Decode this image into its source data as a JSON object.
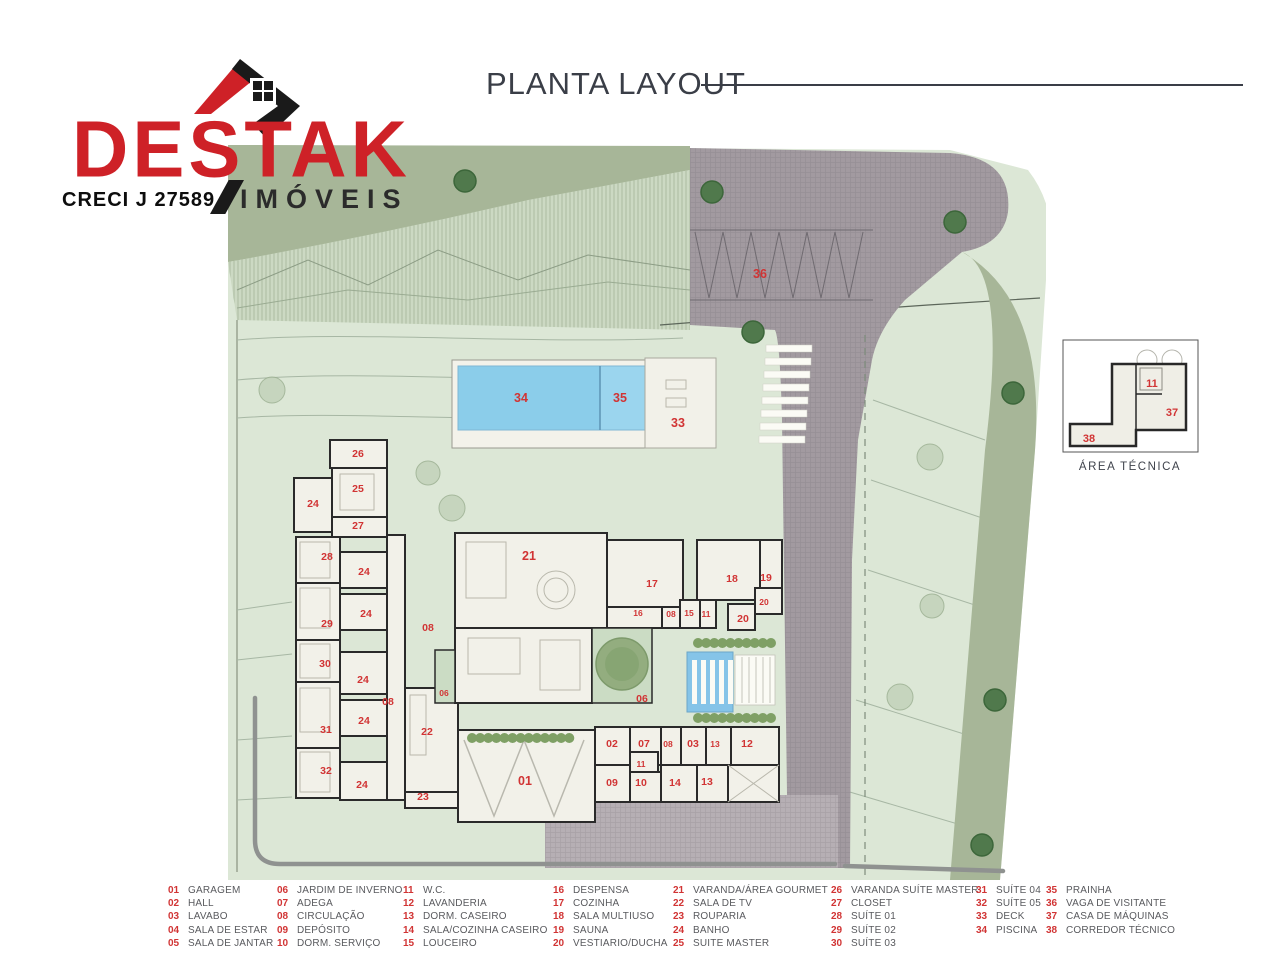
{
  "logo": {
    "brand": "DESTAK",
    "brand_sub": "IMÓVEIS",
    "creci": "CRECI J 27589",
    "brand_color": "#ce2127",
    "sub_color": "#2b2b2b"
  },
  "title": "PLANTA LAYOUT",
  "inset": {
    "caption": "ÁREA TÉCNICA",
    "labels": [
      {
        "n": "11",
        "x": 90,
        "y": 49
      },
      {
        "n": "37",
        "x": 110,
        "y": 78
      },
      {
        "n": "38",
        "x": 27,
        "y": 104
      }
    ]
  },
  "plan": {
    "colors": {
      "lot_green": "#dce7d6",
      "verge_sage": "#a7b698",
      "road_gray": "#a29aa0",
      "pool_blue": "#8bcdea",
      "room_fill": "#f2f1e9",
      "wall": "#2a2a2a",
      "number_red": "#d13434"
    },
    "labels": [
      {
        "n": "36",
        "x": 532,
        "y": 138,
        "s": "lg"
      },
      {
        "n": "34",
        "x": 293,
        "y": 262,
        "s": "lg"
      },
      {
        "n": "35",
        "x": 392,
        "y": 262,
        "s": "lg"
      },
      {
        "n": "33",
        "x": 450,
        "y": 287,
        "s": "lg"
      },
      {
        "n": "26",
        "x": 130,
        "y": 317
      },
      {
        "n": "25",
        "x": 130,
        "y": 352
      },
      {
        "n": "24",
        "x": 85,
        "y": 367
      },
      {
        "n": "27",
        "x": 130,
        "y": 389
      },
      {
        "n": "28",
        "x": 99,
        "y": 420
      },
      {
        "n": "24",
        "x": 136,
        "y": 435
      },
      {
        "n": "24",
        "x": 138,
        "y": 477
      },
      {
        "n": "29",
        "x": 99,
        "y": 487
      },
      {
        "n": "08",
        "x": 200,
        "y": 491
      },
      {
        "n": "30",
        "x": 97,
        "y": 527
      },
      {
        "n": "24",
        "x": 135,
        "y": 543
      },
      {
        "n": "06",
        "x": 216,
        "y": 556,
        "s": "sm"
      },
      {
        "n": "08",
        "x": 160,
        "y": 565
      },
      {
        "n": "24",
        "x": 136,
        "y": 584
      },
      {
        "n": "31",
        "x": 98,
        "y": 593
      },
      {
        "n": "22",
        "x": 199,
        "y": 595
      },
      {
        "n": "32",
        "x": 98,
        "y": 634
      },
      {
        "n": "24",
        "x": 134,
        "y": 648
      },
      {
        "n": "23",
        "x": 195,
        "y": 660
      },
      {
        "n": "21",
        "x": 301,
        "y": 420,
        "s": "lg"
      },
      {
        "n": "17",
        "x": 424,
        "y": 447
      },
      {
        "n": "16",
        "x": 410,
        "y": 476,
        "s": "sm"
      },
      {
        "n": "08",
        "x": 443,
        "y": 477,
        "s": "sm"
      },
      {
        "n": "15",
        "x": 461,
        "y": 476,
        "s": "sm"
      },
      {
        "n": "11",
        "x": 478,
        "y": 477,
        "s": "sm"
      },
      {
        "n": "18",
        "x": 504,
        "y": 442
      },
      {
        "n": "19",
        "x": 538,
        "y": 441
      },
      {
        "n": "20",
        "x": 536,
        "y": 465,
        "s": "sm"
      },
      {
        "n": "20",
        "x": 515,
        "y": 482
      },
      {
        "n": "06",
        "x": 414,
        "y": 562
      },
      {
        "n": "01",
        "x": 297,
        "y": 645,
        "s": "lg"
      },
      {
        "n": "02",
        "x": 384,
        "y": 607
      },
      {
        "n": "07",
        "x": 416,
        "y": 607
      },
      {
        "n": "08",
        "x": 440,
        "y": 607,
        "s": "sm"
      },
      {
        "n": "03",
        "x": 465,
        "y": 607
      },
      {
        "n": "13",
        "x": 487,
        "y": 607,
        "s": "sm"
      },
      {
        "n": "12",
        "x": 519,
        "y": 607
      },
      {
        "n": "09",
        "x": 384,
        "y": 646
      },
      {
        "n": "11",
        "x": 413,
        "y": 627,
        "s": "sm"
      },
      {
        "n": "10",
        "x": 413,
        "y": 646
      },
      {
        "n": "14",
        "x": 447,
        "y": 646
      },
      {
        "n": "13",
        "x": 479,
        "y": 645
      }
    ]
  },
  "legend": {
    "groups": [
      [
        {
          "n": "01",
          "label": "GARAGEM"
        },
        {
          "n": "02",
          "label": "HALL"
        },
        {
          "n": "03",
          "label": "LAVABO"
        },
        {
          "n": "04",
          "label": "SALA DE ESTAR"
        },
        {
          "n": "05",
          "label": "SALA DE JANTAR"
        }
      ],
      [
        {
          "n": "06",
          "label": "JARDIM DE INVERNO"
        },
        {
          "n": "07",
          "label": "ADEGA"
        },
        {
          "n": "08",
          "label": "CIRCULAÇÃO"
        },
        {
          "n": "09",
          "label": "DEPÓSITO"
        },
        {
          "n": "10",
          "label": "DORM. SERVIÇO"
        }
      ],
      [
        {
          "n": "11",
          "label": "W.C."
        },
        {
          "n": "12",
          "label": "LAVANDERIA"
        },
        {
          "n": "13",
          "label": "DORM. CASEIRO"
        },
        {
          "n": "14",
          "label": "SALA/COZINHA CASEIRO"
        },
        {
          "n": "15",
          "label": "LOUCEIRO"
        }
      ],
      [
        {
          "n": "16",
          "label": "DESPENSA"
        },
        {
          "n": "17",
          "label": "COZINHA"
        },
        {
          "n": "18",
          "label": "SALA MULTIUSO"
        },
        {
          "n": "19",
          "label": "SAUNA"
        },
        {
          "n": "20",
          "label": "VESTIARIO/DUCHA"
        }
      ],
      [
        {
          "n": "21",
          "label": "VARANDA/ÁREA GOURMET"
        },
        {
          "n": "22",
          "label": "SALA DE TV"
        },
        {
          "n": "23",
          "label": "ROUPARIA"
        },
        {
          "n": "24",
          "label": "BANHO"
        },
        {
          "n": "25",
          "label": "SUITE MASTER"
        }
      ],
      [
        {
          "n": "26",
          "label": "VARANDA SUÍTE MASTER"
        },
        {
          "n": "27",
          "label": "CLOSET"
        },
        {
          "n": "28",
          "label": "SUÍTE 01"
        },
        {
          "n": "29",
          "label": "SUÍTE 02"
        },
        {
          "n": "30",
          "label": "SUÍTE 03"
        }
      ],
      [
        {
          "n": "31",
          "label": "SUÍTE 04"
        },
        {
          "n": "32",
          "label": "SUÍTE 05"
        },
        {
          "n": "33",
          "label": "DECK"
        },
        {
          "n": "34",
          "label": "PISCINA"
        }
      ],
      [
        {
          "n": "35",
          "label": "PRAINHA"
        },
        {
          "n": "36",
          "label": "VAGA DE VISITANTE"
        },
        {
          "n": "37",
          "label": "CASA DE MÁQUINAS"
        },
        {
          "n": "38",
          "label": "CORREDOR TÉCNICO"
        }
      ]
    ]
  }
}
